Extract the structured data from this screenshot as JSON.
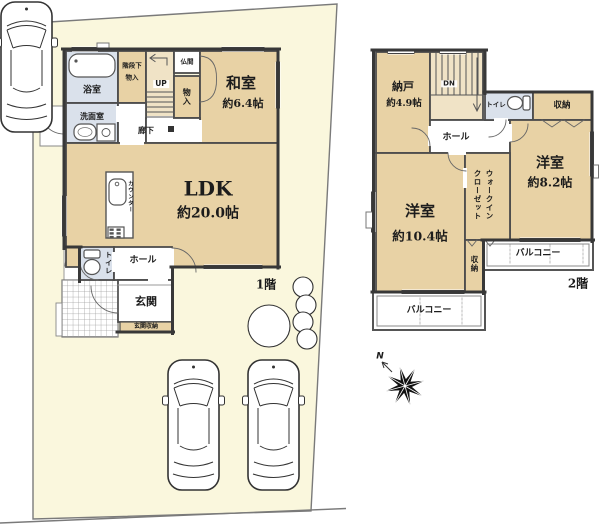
{
  "floor1": {
    "label": "1階",
    "bathroom": "浴室",
    "washroom": "洗面室",
    "under_stair_storage_line1": "階段下",
    "under_stair_storage_line2": "物入",
    "stairs_up": "UP",
    "butsuma": "仏間",
    "closet": "物入",
    "washitsu": "和室",
    "washitsu_size": "約6.4帖",
    "hallway": "廊下",
    "ldk": "LDK",
    "ldk_size": "約20.0帖",
    "counter": "カウンター",
    "toilet": "トイレ",
    "hall": "ホール",
    "entrance": "玄関",
    "entrance_storage": "玄関収納"
  },
  "floor2": {
    "label": "2階",
    "storeroom": "納戸",
    "storeroom_size": "約4.9帖",
    "stairs_down": "DN",
    "hall": "ホール",
    "toilet": "トイレ",
    "storage_top": "収納",
    "bedroom1": "洋室",
    "bedroom1_size": "約8.2帖",
    "bedroom2": "洋室",
    "bedroom2_size": "約10.4帖",
    "wic_line1": "ウォークイン",
    "wic_line2": "クローゼット",
    "storage_side": "収納",
    "balcony_right": "バルコニー",
    "balcony_bottom": "バルコニー"
  },
  "compass": {
    "north": "N"
  },
  "colors": {
    "site_fill": "#FAF7DD",
    "room_tan": "#E8D2A5",
    "stair_tan": "#F0E3C6",
    "wet_area_blue": "#DAE1EB",
    "wall": "#3E3E3E"
  }
}
